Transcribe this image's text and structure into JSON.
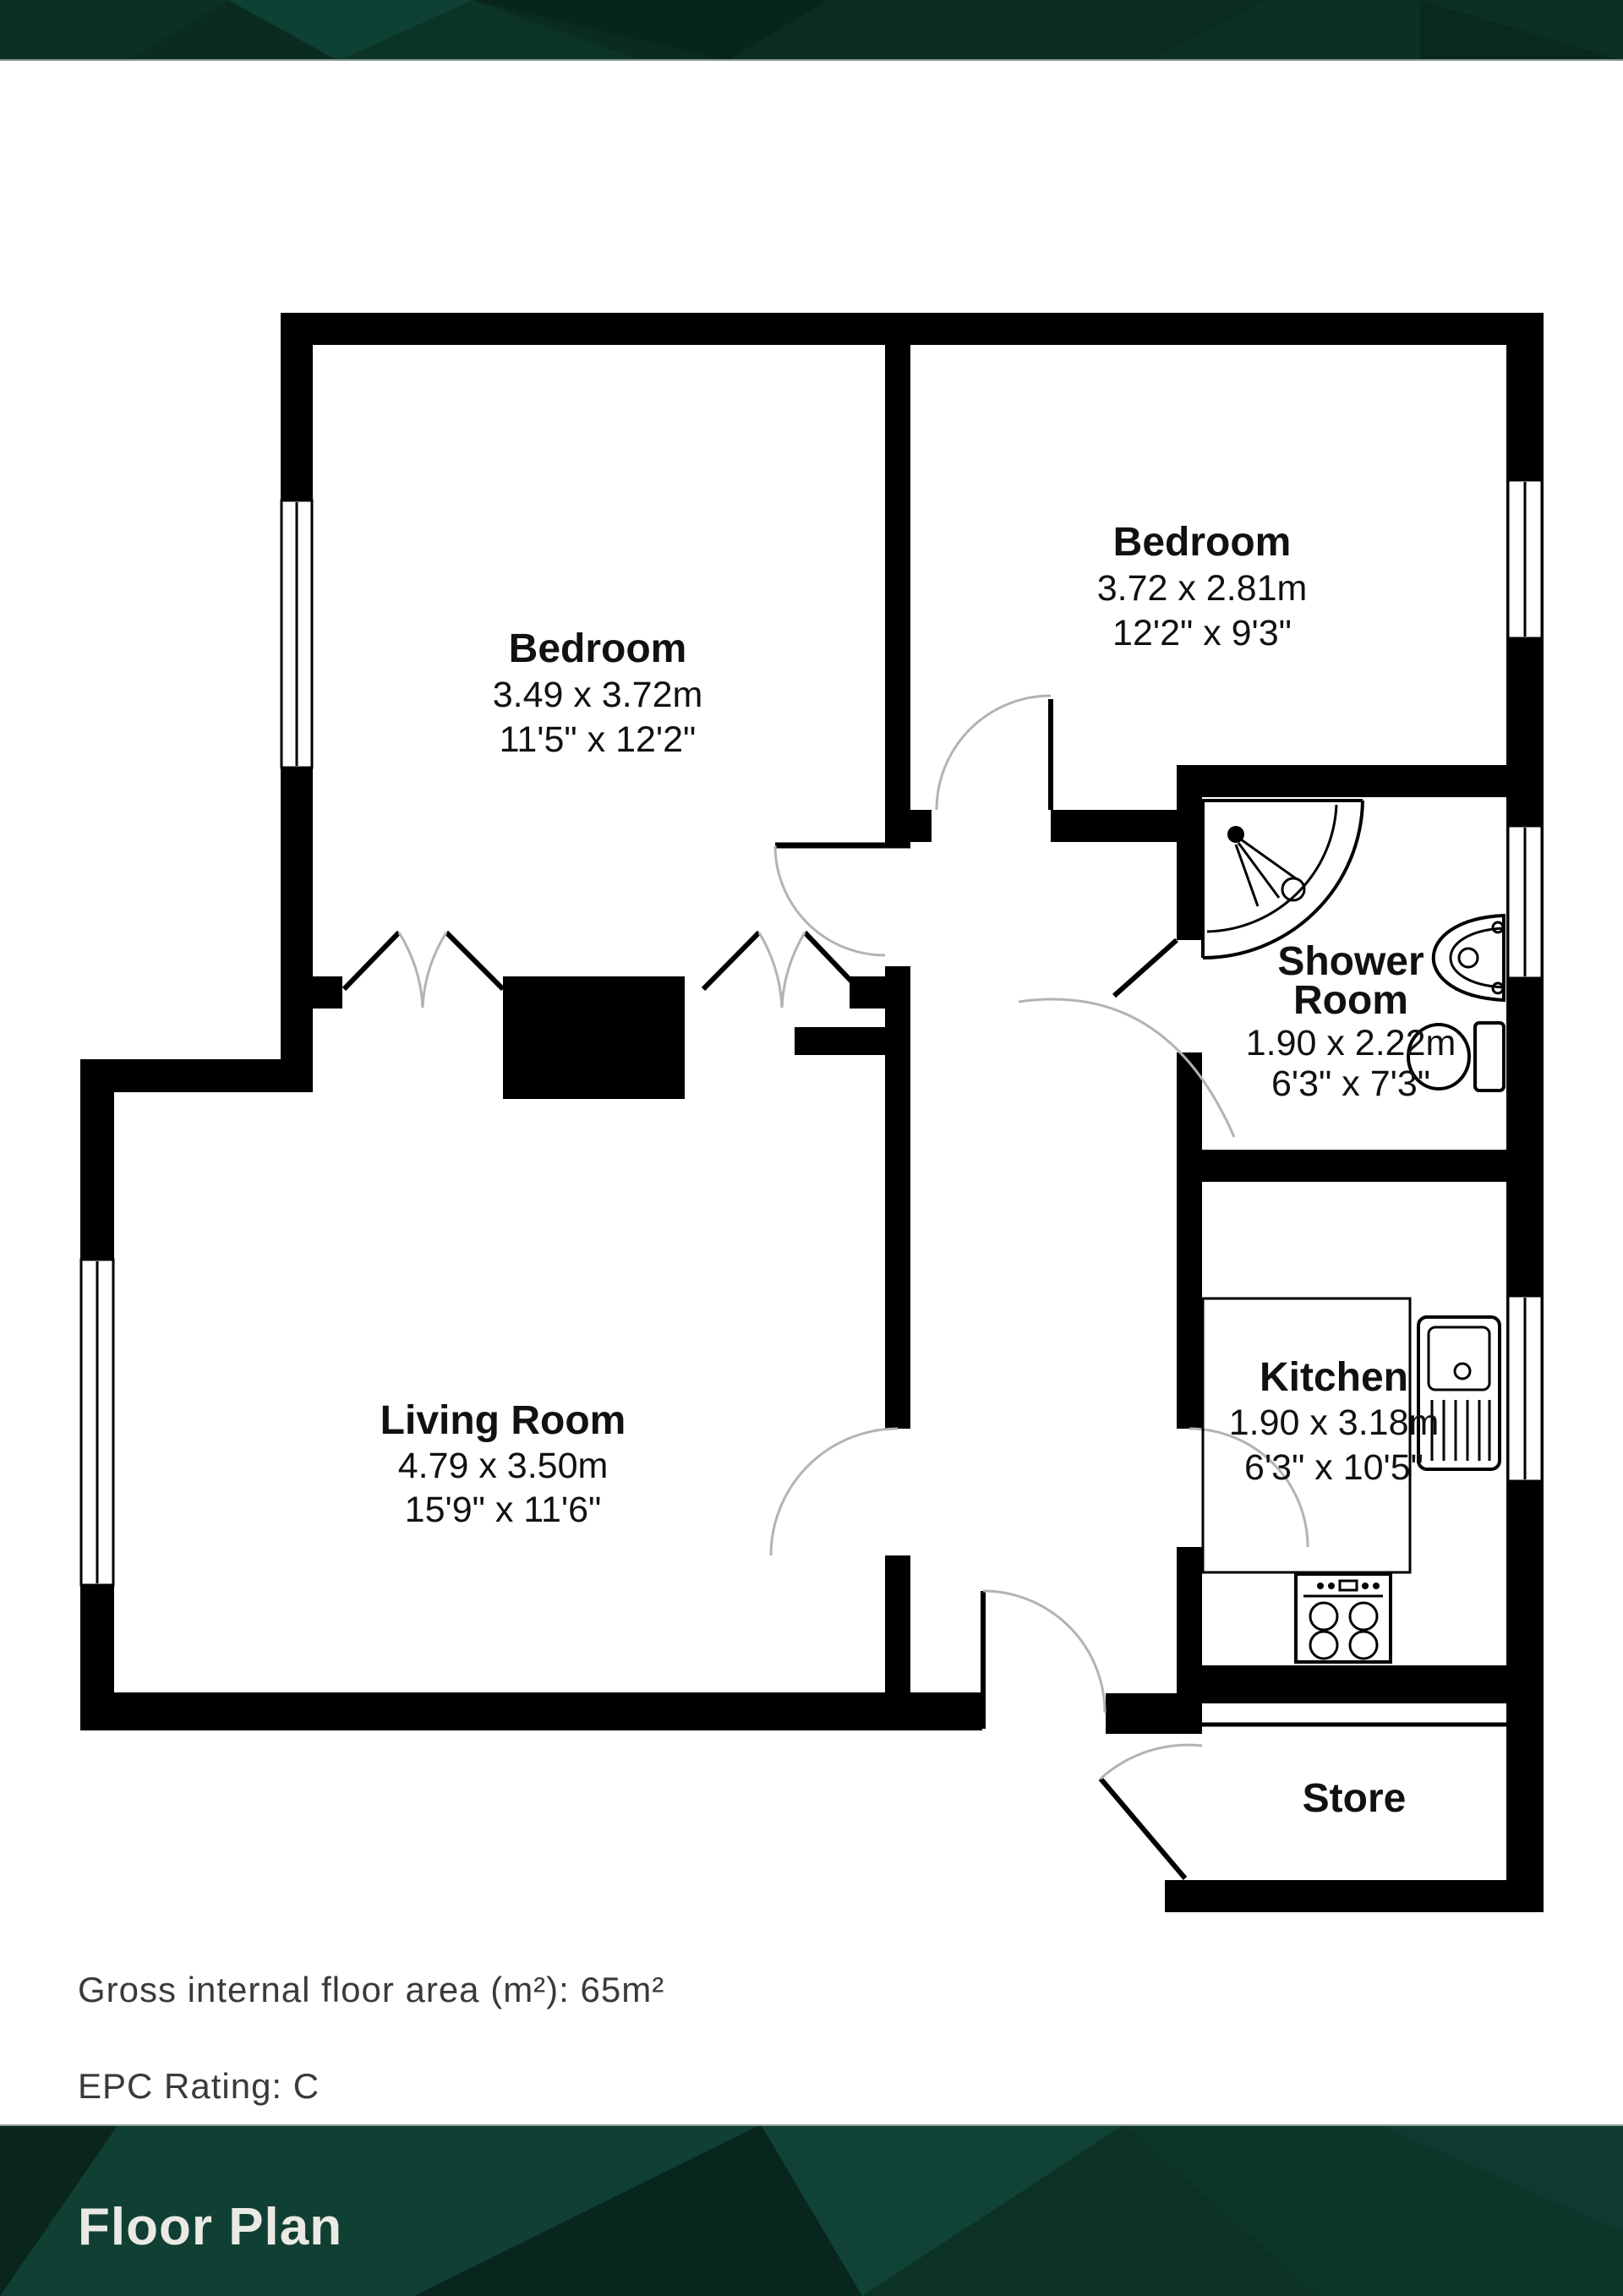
{
  "banner": {
    "top_color": "#0a2b20",
    "facet_light": "#14473a",
    "facet_dark": "#071f16",
    "edge_line": "#8d9c95"
  },
  "floorplan": {
    "wall_color": "#000000",
    "door_arc_color": "#b3b3b3",
    "rooms": [
      {
        "name": "Bedroom",
        "metric": "3.49 x 3.72m",
        "imperial": "11'5\" x 12'2\""
      },
      {
        "name": "Bedroom",
        "metric": "3.72 x 2.81m",
        "imperial": "12'2\" x 9'3\""
      },
      {
        "name": "Shower Room",
        "name_lines": [
          "Shower",
          "Room"
        ],
        "metric": "1.90 x 2.22m",
        "imperial": "6'3\" x 7'3\""
      },
      {
        "name": "Living Room",
        "metric": "4.79 x 3.50m",
        "imperial": "15'9\" x 11'6\""
      },
      {
        "name": "Kitchen",
        "metric": "1.90 x 3.18m",
        "imperial": "6'3\" x 10'5\""
      },
      {
        "name": "Store"
      }
    ],
    "fixtures": [
      "corner-shower",
      "basin",
      "toilet",
      "kitchen-sink",
      "stove",
      "kitchen-counter"
    ]
  },
  "info": {
    "area_line": "Gross internal floor area (m²): 65m²",
    "epc_line": "EPC Rating: C"
  },
  "footer": {
    "title": "Floor Plan",
    "text_color": "#ebe9e3"
  }
}
